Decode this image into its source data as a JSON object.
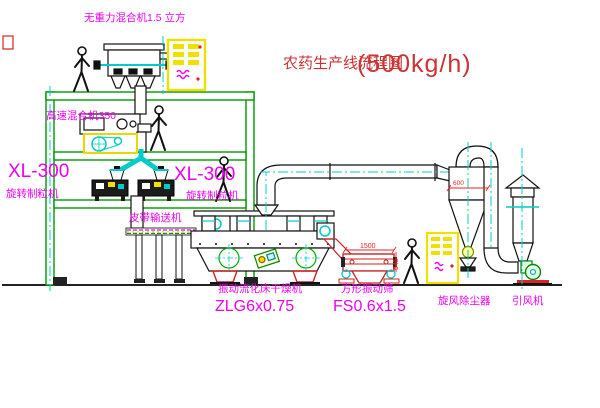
{
  "title": {
    "name": "农药生产线流程图",
    "capacity": "(500kg/h)"
  },
  "labels": {
    "gravity_free_mixer": "无重力混合机1.5 立方",
    "high_speed_mixer": "高速混合机350",
    "granulator_left_model": "XL-300",
    "granulator_left_name": "旋转制粒机",
    "granulator_mid_model": "XL-300",
    "granulator_mid_name": "旋转制粒机",
    "belt_conveyor": "皮带输送机",
    "dryer_name": "振动流化床干燥机",
    "dryer_model": "ZLG6x0.75",
    "sieve_name": "方形振动筛",
    "sieve_model": "FS0.6x1.5",
    "cyclone": "旋风除尘器",
    "fan": "引风机"
  },
  "dimensions": {
    "sieve_length": "1500",
    "sieve_height": "545",
    "cyclone_diameter": "600"
  },
  "colors": {
    "structure_green": "#009900",
    "centerline_cyan": "#00cccc",
    "label_magenta": "#ee00ee",
    "title_red": "#cc3333",
    "cabinet_yellow": "#f0e000",
    "dimension_red": "#ee2222"
  }
}
